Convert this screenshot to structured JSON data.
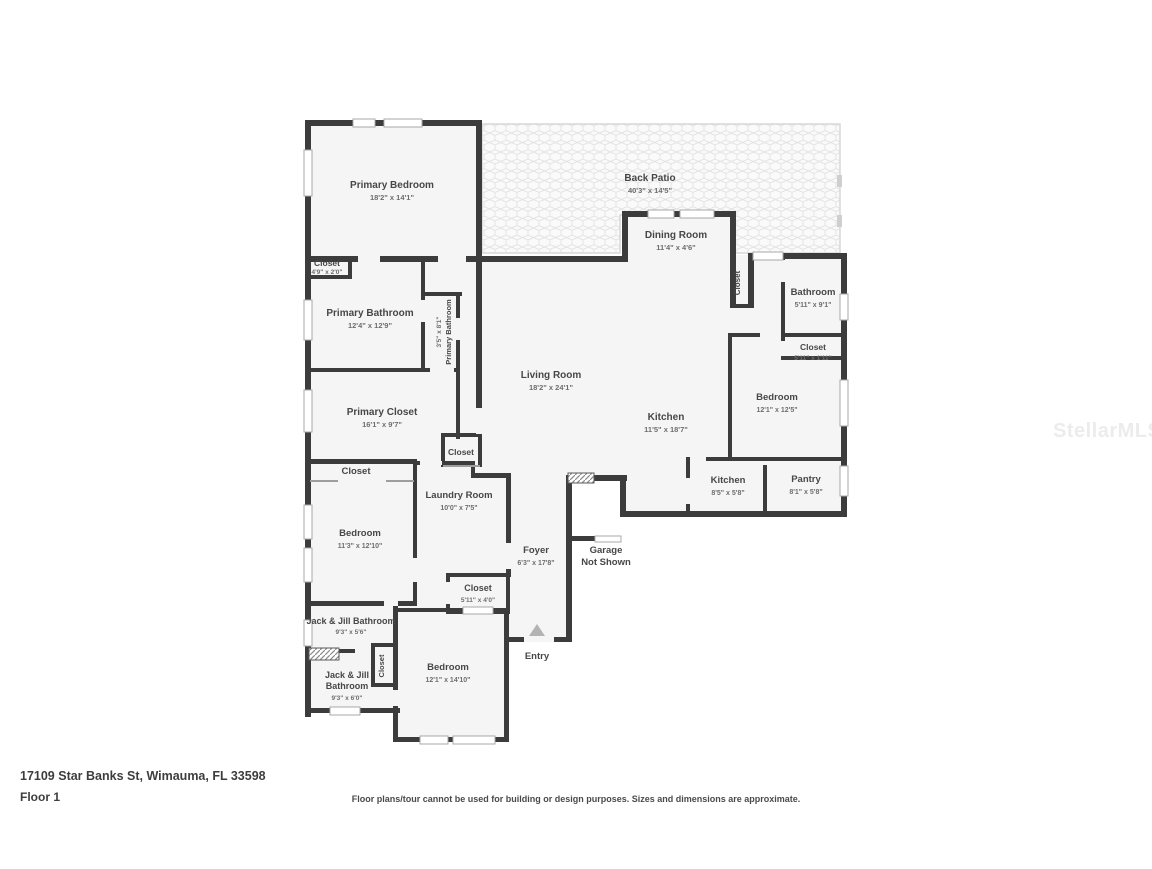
{
  "floorplan": {
    "address": "17109 Star Banks St, Wimauma, FL 33598",
    "floor_label": "Floor 1",
    "disclaimer": "Floor plans/tour cannot be used for building or design purposes. Sizes and dimensions are approximate.",
    "watermark": "StellarMLS",
    "entry_label": "Entry",
    "garage": {
      "line1": "Garage",
      "line2": "Not Shown"
    },
    "rooms": {
      "primary_bedroom": {
        "name": "Primary Bedroom",
        "dims": "18'2\" x 14'1\""
      },
      "back_patio": {
        "name": "Back Patio",
        "dims": "40'3\" x 14'5\""
      },
      "dining_room": {
        "name": "Dining Room",
        "dims": "11'4\" x 4'6\""
      },
      "closet_dining": {
        "name": "Closet"
      },
      "bathroom": {
        "name": "Bathroom",
        "dims": "5'11\" x 9'1\""
      },
      "closet_bathroom": {
        "name": "Closet",
        "dims": "5'11\" x 1'11\""
      },
      "bedroom_right": {
        "name": "Bedroom",
        "dims": "12'1\" x 12'5\""
      },
      "living_room": {
        "name": "Living Room",
        "dims": "18'2\" x 24'1\""
      },
      "kitchen": {
        "name": "Kitchen",
        "dims": "11'5\" x 18'7\""
      },
      "closet_primary_bed": {
        "name": "Closet",
        "dims": "4'9\" x 2'0\""
      },
      "primary_bathroom": {
        "name": "Primary Bathroom",
        "dims": "12'4\" x 12'9\""
      },
      "primary_bathroom_2": {
        "name": "Primary Bathroom",
        "dims": "3'5\" x 8'1\""
      },
      "primary_closet": {
        "name": "Primary Closet",
        "dims": "16'1\" x 9'7\""
      },
      "closet_hall": {
        "name": "Closet"
      },
      "closet_bedroom_left": {
        "name": "Closet"
      },
      "laundry_room": {
        "name": "Laundry Room",
        "dims": "10'0\" x 7'5\""
      },
      "bedroom_left": {
        "name": "Bedroom",
        "dims": "11'3\" x 12'10\""
      },
      "foyer": {
        "name": "Foyer",
        "dims": "6'3\" x 17'8\""
      },
      "kitchen_small": {
        "name": "Kitchen",
        "dims": "8'5\" x 5'8\""
      },
      "pantry": {
        "name": "Pantry",
        "dims": "8'1\" x 5'8\""
      },
      "closet_entry": {
        "name": "Closet",
        "dims": "5'11\" x 4'0\""
      },
      "jack_jill_bathroom_1": {
        "name": "Jack & Jill Bathroom",
        "dims": "9'3\" x 5'6\""
      },
      "closet_jj": {
        "name": "Closet"
      },
      "jack_jill_bathroom_2": {
        "name": "Jack & Jill",
        "name2": "Bathroom",
        "dims": "9'3\" x 6'0\""
      },
      "bedroom_bottom": {
        "name": "Bedroom",
        "dims": "12'1\" x 14'10\""
      }
    },
    "colors": {
      "wall": "#3c3c3c",
      "room_fill": "#f5f5f5",
      "patio_line": "#e2e2e2"
    }
  }
}
